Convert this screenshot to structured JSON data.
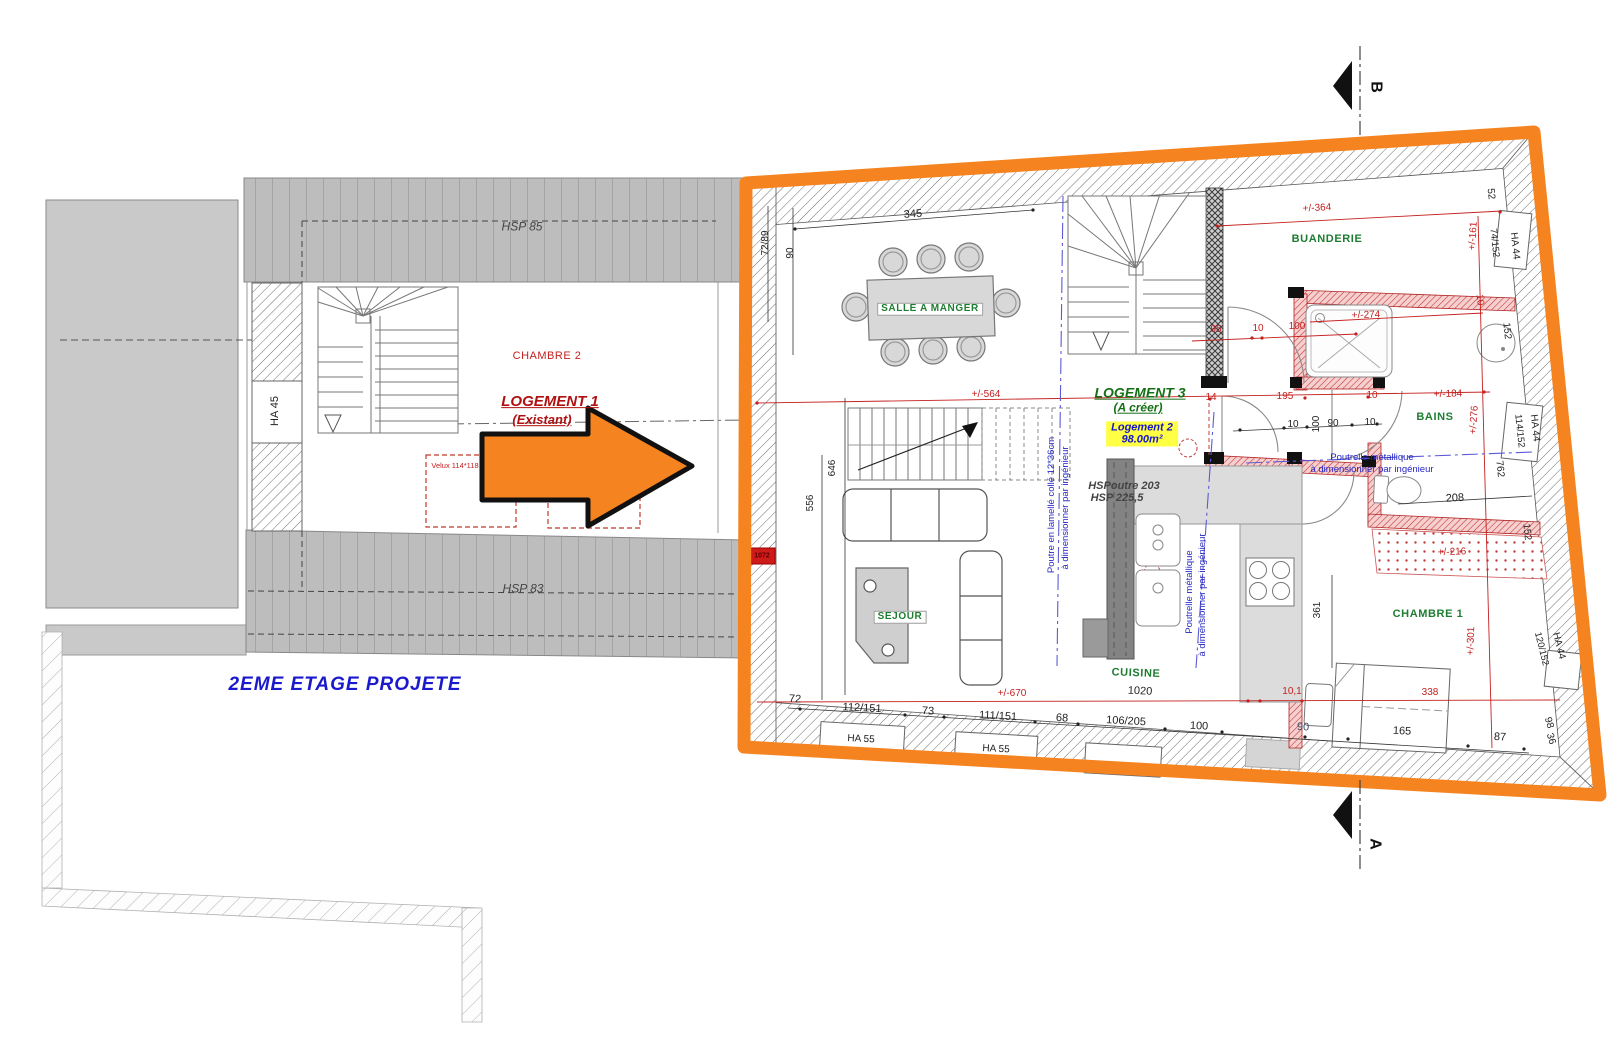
{
  "colors": {
    "accent_orange": "#f5831f",
    "dim_red": "#c4201f",
    "room_green": "#1e7d32",
    "note_blue": "#2525c4",
    "title_blue": "#1a1acc",
    "logement_red": "#b01010",
    "highlight_yellow": "#ffff43"
  },
  "left_plan": {
    "hsp_top": "HSP 85",
    "hsp_bottom": "HSP 83",
    "wall_tag": "HA 45",
    "room": "CHAMBRE 2",
    "unit_title": "LOGEMENT 1",
    "unit_subtitle": "(Existant)",
    "velux": "Velux 114*118",
    "caption": "2EME ETAGE PROJETE"
  },
  "right_plan": {
    "unit_title": "LOGEMENT 3",
    "unit_subtitle": "(A créer)",
    "badge": {
      "line1": "Logement 2",
      "line2": "98.00m²"
    },
    "rooms": {
      "dining": "SALLE A MANGER",
      "laundry": "BUANDERIE",
      "bath": "BAINS",
      "bedroom": "CHAMBRE 1",
      "living": "SEJOUR",
      "kitchen": "CUISINE"
    },
    "notes": {
      "beam_height_1": "HSPoutre 203",
      "beam_height_2": "HSP 225,5",
      "glulam_1": "Poutre en lamellé collé 12*36cm",
      "glulam_2": "à dimensionner par ingénieur",
      "steel_v_1": "Poutrelle métallique",
      "steel_v_2": "à dimensionner par ingénieur",
      "steel_h_1": "Poutrelle métallique",
      "steel_h_2": "à dimensionner par ingénieur"
    },
    "marker": "1072",
    "windows": {
      "ha44_top": "HA 44",
      "ha44_mid": "HA 44",
      "ha44_bot": "HA 44",
      "ha55_1": "HA 55",
      "ha55_2": "HA 55",
      "w74": "74/152",
      "w114": "114/152",
      "w120": "120/152"
    },
    "dims_red": {
      "d564": "+/-564",
      "d364": "+/-364",
      "d274": "+/-274",
      "d95": "95",
      "d10a": "10",
      "d100": "100",
      "d14": "14",
      "d195": "195",
      "d10b": "10",
      "d184": "+/-184",
      "d161": "+/-161",
      "d276": "+/-276",
      "d10w": "10",
      "d216": "+/-216",
      "d301": "+/-301",
      "d670": "+/-670",
      "d101": "10,1",
      "d338": "338"
    },
    "dims_black": {
      "d345": "345",
      "d7289": "72/89",
      "d90t": "90",
      "d646": "646",
      "d556": "556",
      "d10c": "10",
      "d100r": "100",
      "d90m": "90",
      "d10d": "10",
      "d208": "208",
      "d361": "361",
      "d52": "52",
      "d152a": "152",
      "d152b": "152",
      "d762": "762",
      "d1020": "1020",
      "d72": "72",
      "d112151": "112/151",
      "d73": "73",
      "d111151": "111/151",
      "d68": "68",
      "d106205": "106/205",
      "d100b": "100",
      "d90b": "90",
      "d165": "165",
      "d87": "87",
      "d98": "98",
      "d36": "36"
    }
  },
  "sections": {
    "top": "B",
    "bottom": "A"
  }
}
